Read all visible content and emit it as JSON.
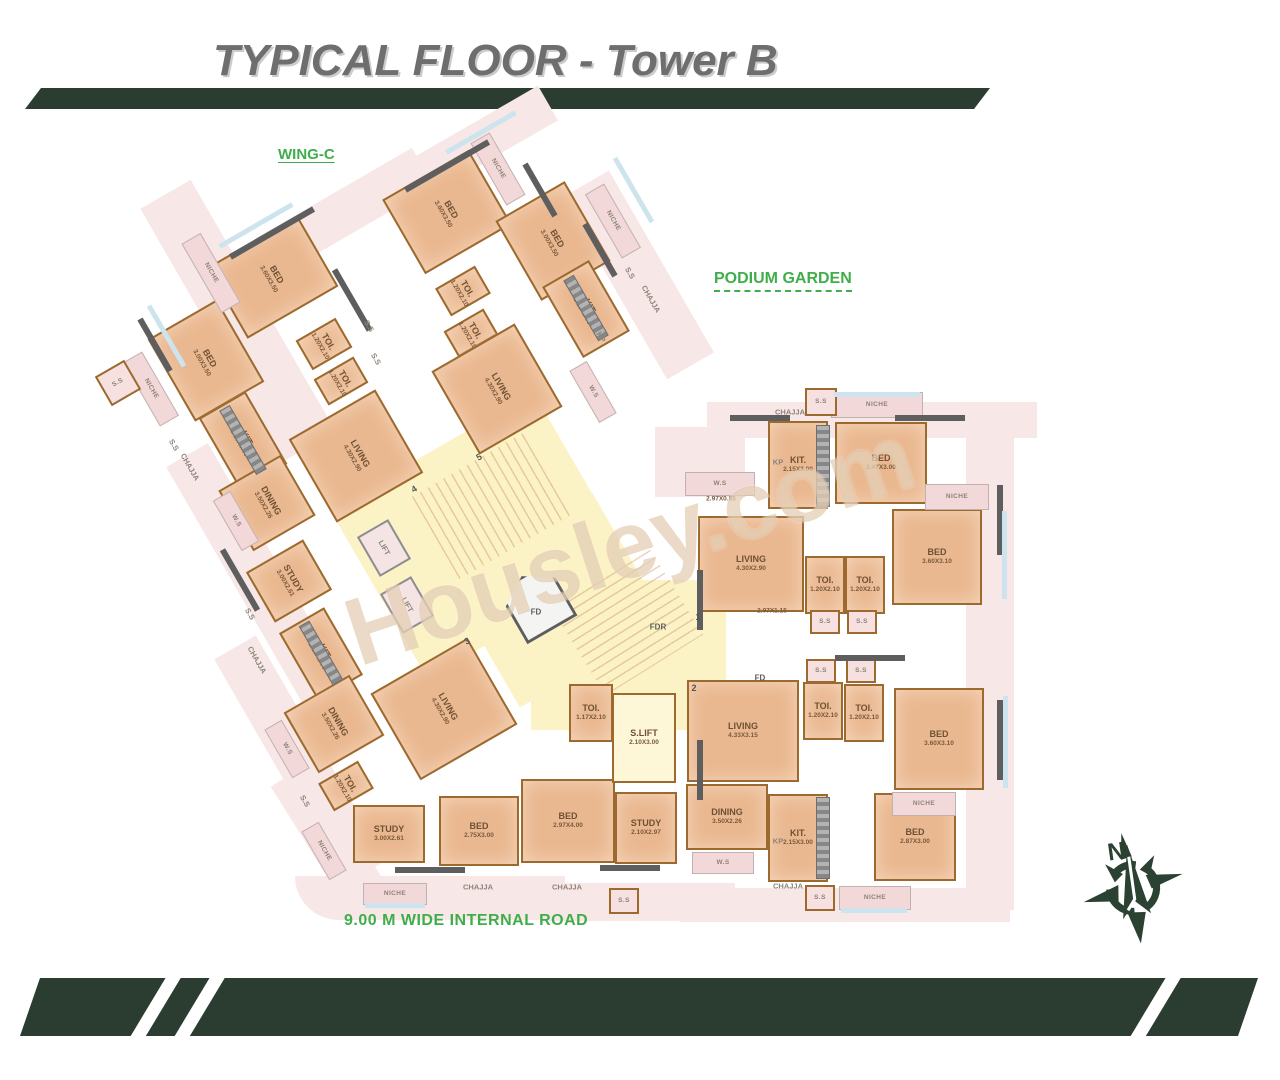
{
  "header": {
    "title": "TYPICAL FLOOR - Tower B"
  },
  "labels": {
    "wing": "WING-C",
    "garden": "PODIUM GARDEN",
    "road": "9.00 M WIDE INTERNAL ROAD",
    "watermark": "Housley.com",
    "compass_north": "N"
  },
  "colors": {
    "banner_green": "#2b3c30",
    "annotation_green": "#3fae4a",
    "room_fill": "#eab890",
    "niche_fill": "#f3d8d9",
    "core_fill": "#fbf2c5",
    "wall_brown": "#9c6a2f",
    "wall_gray": "#5e5e5e",
    "sill_blue": "#cde4ee",
    "title_gray": "#6e6e6e"
  },
  "plan": {
    "items": [
      {
        "k": "outer",
        "x": 238,
        "y": 320,
        "w": 58,
        "h": 290,
        "r": -30
      },
      {
        "k": "outer",
        "x": 345,
        "y": 212,
        "w": 180,
        "h": 44,
        "r": -30
      },
      {
        "k": "outer",
        "x": 262,
        "y": 585,
        "w": 48,
        "h": 300,
        "r": -30
      },
      {
        "k": "outer",
        "x": 300,
        "y": 760,
        "w": 48,
        "h": 260,
        "r": -30
      },
      {
        "k": "outer",
        "x": 330,
        "y": 838,
        "w": 46,
        "h": 150,
        "r": -32
      },
      {
        "k": "outer",
        "x": 470,
        "y": 148,
        "w": 180,
        "h": 40,
        "r": -30
      },
      {
        "k": "outer",
        "x": 638,
        "y": 275,
        "w": 54,
        "h": 210,
        "r": -30
      },
      {
        "k": "outer",
        "x": 430,
        "y": 898,
        "w": 270,
        "h": 44,
        "r": 0,
        "br": 60
      },
      {
        "k": "outer",
        "x": 640,
        "y": 902,
        "w": 190,
        "h": 38,
        "r": 0
      },
      {
        "k": "outer",
        "x": 872,
        "y": 420,
        "w": 330,
        "h": 36,
        "r": 0
      },
      {
        "k": "outer",
        "x": 990,
        "y": 660,
        "w": 48,
        "h": 500,
        "r": 0
      },
      {
        "k": "outer",
        "x": 845,
        "y": 905,
        "w": 330,
        "h": 34,
        "r": 0
      },
      {
        "k": "outer",
        "x": 700,
        "y": 462,
        "w": 90,
        "h": 70,
        "r": 0
      },
      {
        "k": "core",
        "x": 480,
        "y": 535,
        "w": 235,
        "h": 195,
        "r": -30
      },
      {
        "k": "core",
        "x": 628,
        "y": 655,
        "w": 195,
        "h": 150,
        "r": 0
      },
      {
        "k": "core",
        "x": 556,
        "y": 600,
        "w": 170,
        "h": 150,
        "r": -30
      },
      {
        "k": "stairs",
        "x": 492,
        "y": 505,
        "w": 130,
        "h": 95,
        "r": -30
      },
      {
        "k": "stairs",
        "x": 628,
        "y": 622,
        "w": 100,
        "h": 115,
        "r": 58
      },
      {
        "k": "fd",
        "x": 537,
        "y": 603,
        "w": 58,
        "h": 62,
        "r": -30
      },
      {
        "k": "lift",
        "l": "LIFT",
        "x": 384,
        "y": 548,
        "w": 36,
        "h": 46,
        "r": -30,
        "lr": 90
      },
      {
        "k": "lift",
        "l": "LIFT",
        "x": 407,
        "y": 605,
        "w": 36,
        "h": 46,
        "r": -30,
        "lr": 90
      },
      {
        "k": "room",
        "l": "BED",
        "d": "3.60X3.50",
        "x": 272,
        "y": 277,
        "w": 105,
        "h": 82,
        "r": -30,
        "lr": 90
      },
      {
        "k": "room",
        "l": "BED",
        "d": "3.00X3.50",
        "x": 206,
        "y": 360,
        "w": 80,
        "h": 95,
        "r": -30,
        "lr": 90
      },
      {
        "k": "room",
        "l": "TOI.",
        "d": "1.20X2.10",
        "x": 324,
        "y": 344,
        "w": 46,
        "h": 34,
        "r": -30,
        "lr": 90
      },
      {
        "k": "room",
        "l": "TOI.",
        "d": "1.20X2.10",
        "x": 341,
        "y": 381,
        "w": 46,
        "h": 30,
        "r": -30,
        "lr": 90
      },
      {
        "k": "room",
        "l": "KIT.",
        "d": "2.15X3.00",
        "x": 243,
        "y": 441,
        "w": 54,
        "h": 84,
        "r": -30,
        "lr": 90
      },
      {
        "k": "room",
        "l": "DINING",
        "d": "3.50X2.26",
        "x": 267,
        "y": 503,
        "w": 72,
        "h": 70,
        "r": -30,
        "lr": 90
      },
      {
        "k": "room",
        "l": "LIVING",
        "d": "4.30X2.90",
        "x": 356,
        "y": 456,
        "w": 100,
        "h": 96,
        "r": -30,
        "lr": 90
      },
      {
        "k": "room",
        "l": "BED",
        "d": "3.60X3.50",
        "x": 447,
        "y": 212,
        "w": 100,
        "h": 86,
        "r": -30,
        "lr": 90
      },
      {
        "k": "room",
        "l": "BED",
        "d": "3.00X3.50",
        "x": 553,
        "y": 241,
        "w": 80,
        "h": 92,
        "r": -30,
        "lr": 90
      },
      {
        "k": "room",
        "l": "TOI.",
        "d": "1.20X2.10",
        "x": 463,
        "y": 291,
        "w": 46,
        "h": 32,
        "r": -30,
        "lr": 90
      },
      {
        "k": "room",
        "l": "TOI.",
        "d": "1.20X2.10",
        "x": 471,
        "y": 333,
        "w": 46,
        "h": 30,
        "r": -30,
        "lr": 90
      },
      {
        "k": "room",
        "l": "KIT.",
        "d": "2.15X3.00",
        "x": 586,
        "y": 309,
        "w": 54,
        "h": 82,
        "r": -30,
        "lr": 90
      },
      {
        "k": "room",
        "l": "LIVING",
        "d": "4.30X2.90",
        "x": 497,
        "y": 389,
        "w": 96,
        "h": 96,
        "r": -30,
        "lr": 90
      },
      {
        "k": "room",
        "l": "STUDY",
        "d": "3.00X2.61",
        "x": 289,
        "y": 581,
        "w": 66,
        "h": 58,
        "r": -30,
        "lr": 90
      },
      {
        "k": "room",
        "l": "KIT.",
        "d": "2.15X3.00",
        "x": 321,
        "y": 654,
        "w": 52,
        "h": 78,
        "r": -30,
        "lr": 90
      },
      {
        "k": "room",
        "l": "DINING",
        "d": "3.50X2.26",
        "x": 334,
        "y": 724,
        "w": 76,
        "h": 70,
        "r": -30,
        "lr": 90
      },
      {
        "k": "room",
        "l": "LIVING",
        "d": "4.30X2.90",
        "x": 444,
        "y": 709,
        "w": 112,
        "h": 100,
        "r": -30,
        "lr": 90
      },
      {
        "k": "room",
        "l": "TOI.",
        "d": "1.20X2.10",
        "x": 346,
        "y": 786,
        "w": 46,
        "h": 32,
        "r": -30,
        "lr": 90
      },
      {
        "k": "room",
        "l": "STUDY",
        "d": "3.00X2.61",
        "x": 389,
        "y": 834,
        "w": 72,
        "h": 58,
        "r": 0
      },
      {
        "k": "room",
        "l": "BED",
        "d": "2.75X3.00",
        "x": 479,
        "y": 831,
        "w": 80,
        "h": 70,
        "r": 0
      },
      {
        "k": "room",
        "l": "BED",
        "d": "2.97X4.00",
        "x": 568,
        "y": 821,
        "w": 94,
        "h": 84,
        "r": 0
      },
      {
        "k": "room",
        "l": "STUDY",
        "d": "2.10X2.97",
        "x": 646,
        "y": 828,
        "w": 62,
        "h": 72,
        "r": 0
      },
      {
        "k": "room",
        "l": "TOI.",
        "d": "1.17X2.10",
        "x": 591,
        "y": 713,
        "w": 44,
        "h": 58,
        "r": 0
      },
      {
        "k": "corerm",
        "l": "S.LIFT",
        "d": "2.10X3.00",
        "x": 644,
        "y": 738,
        "w": 64,
        "h": 90,
        "r": 0
      },
      {
        "k": "room",
        "l": "KIT.",
        "d": "2.15X3.00",
        "x": 798,
        "y": 465,
        "w": 60,
        "h": 88,
        "r": 0
      },
      {
        "k": "room",
        "l": "BED",
        "d": "2.47X3.00",
        "x": 881,
        "y": 463,
        "w": 92,
        "h": 82,
        "r": 0
      },
      {
        "k": "room",
        "l": "LIVING",
        "d": "4.30X2.90",
        "x": 751,
        "y": 564,
        "w": 106,
        "h": 96,
        "r": 0
      },
      {
        "k": "room",
        "l": "TOI.",
        "d": "1.20X2.10",
        "x": 825,
        "y": 585,
        "w": 40,
        "h": 58,
        "r": 0
      },
      {
        "k": "room",
        "l": "TOI.",
        "d": "1.20X2.10",
        "x": 865,
        "y": 585,
        "w": 40,
        "h": 58,
        "r": 0
      },
      {
        "k": "room",
        "l": "BED",
        "d": "3.60X3.10",
        "x": 937,
        "y": 557,
        "w": 90,
        "h": 96,
        "r": 0
      },
      {
        "k": "room",
        "l": "LIVING",
        "d": "4.33X3.15",
        "x": 743,
        "y": 731,
        "w": 112,
        "h": 102,
        "r": 0
      },
      {
        "k": "room",
        "l": "TOI.",
        "d": "1.20X2.10",
        "x": 823,
        "y": 711,
        "w": 40,
        "h": 58,
        "r": 0
      },
      {
        "k": "room",
        "l": "TOI.",
        "d": "1.20X2.10",
        "x": 864,
        "y": 713,
        "w": 40,
        "h": 58,
        "r": 0
      },
      {
        "k": "room",
        "l": "BED",
        "d": "3.60X3.10",
        "x": 939,
        "y": 739,
        "w": 90,
        "h": 102,
        "r": 0
      },
      {
        "k": "room",
        "l": "DINING",
        "d": "3.50X2.26",
        "x": 727,
        "y": 817,
        "w": 82,
        "h": 66,
        "r": 0
      },
      {
        "k": "room",
        "l": "KIT.",
        "d": "2.15X3.00",
        "x": 798,
        "y": 838,
        "w": 60,
        "h": 88,
        "r": 0
      },
      {
        "k": "room",
        "l": "BED",
        "d": "2.87X3.00",
        "x": 915,
        "y": 837,
        "w": 82,
        "h": 88,
        "r": 0
      },
      {
        "k": "niche",
        "l": "NICHE",
        "x": 211,
        "y": 273,
        "w": 22,
        "h": 80,
        "r": -30,
        "lr": 90
      },
      {
        "k": "niche",
        "l": "NICHE",
        "x": 151,
        "y": 389,
        "w": 22,
        "h": 74,
        "r": -30,
        "lr": 90
      },
      {
        "k": "niche",
        "l": "W.S",
        "x": 236,
        "y": 521,
        "w": 20,
        "h": 58,
        "r": -30,
        "lr": 90
      },
      {
        "k": "niche",
        "l": "W.S",
        "x": 287,
        "y": 749,
        "w": 20,
        "h": 56,
        "r": -30,
        "lr": 90
      },
      {
        "k": "niche",
        "l": "NICHE",
        "x": 324,
        "y": 851,
        "w": 20,
        "h": 56,
        "r": -30,
        "lr": 90
      },
      {
        "k": "niche",
        "l": "NICHE",
        "x": 498,
        "y": 169,
        "w": 22,
        "h": 72,
        "r": -30,
        "lr": 90
      },
      {
        "k": "niche",
        "l": "NICHE",
        "x": 613,
        "y": 221,
        "w": 22,
        "h": 74,
        "r": -30,
        "lr": 90
      },
      {
        "k": "niche",
        "l": "W.S",
        "x": 593,
        "y": 392,
        "w": 20,
        "h": 60,
        "r": -30,
        "lr": 90
      },
      {
        "k": "niche",
        "l": "NICHE",
        "x": 877,
        "y": 405,
        "w": 92,
        "h": 26,
        "r": 0
      },
      {
        "k": "niche",
        "l": "NICHE",
        "x": 957,
        "y": 497,
        "w": 64,
        "h": 26,
        "r": 0
      },
      {
        "k": "niche",
        "l": "W.S",
        "x": 720,
        "y": 484,
        "w": 70,
        "h": 24,
        "r": 0
      },
      {
        "k": "niche",
        "l": "NICHE",
        "x": 924,
        "y": 804,
        "w": 64,
        "h": 24,
        "r": 0
      },
      {
        "k": "niche",
        "l": "NICHE",
        "x": 875,
        "y": 898,
        "w": 72,
        "h": 24,
        "r": 0
      },
      {
        "k": "niche",
        "l": "W.S",
        "x": 723,
        "y": 863,
        "w": 62,
        "h": 22,
        "r": 0
      },
      {
        "k": "niche",
        "l": "NICHE",
        "x": 395,
        "y": 894,
        "w": 64,
        "h": 22,
        "r": 0
      },
      {
        "k": "ssbox",
        "l": "S.S",
        "x": 821,
        "y": 402,
        "w": 32,
        "h": 28,
        "r": 0
      },
      {
        "k": "ssbox",
        "l": "S.S",
        "x": 825,
        "y": 622,
        "w": 30,
        "h": 24,
        "r": 0
      },
      {
        "k": "ssbox",
        "l": "S.S",
        "x": 862,
        "y": 622,
        "w": 30,
        "h": 24,
        "r": 0
      },
      {
        "k": "ssbox",
        "l": "S.S",
        "x": 821,
        "y": 671,
        "w": 30,
        "h": 24,
        "r": 0
      },
      {
        "k": "ssbox",
        "l": "S.S",
        "x": 861,
        "y": 671,
        "w": 30,
        "h": 24,
        "r": 0
      },
      {
        "k": "ssbox",
        "l": "S.S",
        "x": 820,
        "y": 898,
        "w": 30,
        "h": 26,
        "r": 0
      },
      {
        "k": "ssbox",
        "l": "S.S",
        "x": 624,
        "y": 901,
        "w": 30,
        "h": 26,
        "r": 0
      },
      {
        "k": "ssbox",
        "l": "S.S",
        "x": 118,
        "y": 383,
        "w": 34,
        "h": 34,
        "r": -30
      },
      {
        "k": "appl",
        "x": 823,
        "y": 466,
        "w": 14,
        "h": 82,
        "r": 0
      },
      {
        "k": "appl",
        "x": 823,
        "y": 838,
        "w": 14,
        "h": 82,
        "r": 0
      },
      {
        "k": "appl",
        "x": 243,
        "y": 440,
        "w": 12,
        "h": 74,
        "r": -30
      },
      {
        "k": "appl",
        "x": 321,
        "y": 653,
        "w": 12,
        "h": 68,
        "r": -30
      },
      {
        "k": "appl",
        "x": 586,
        "y": 308,
        "w": 12,
        "h": 70,
        "r": -30
      },
      {
        "k": "wall",
        "x": 272,
        "y": 233,
        "w": 96,
        "h": 6,
        "r": -30
      },
      {
        "k": "wall",
        "x": 352,
        "y": 300,
        "w": 6,
        "h": 70,
        "r": -30
      },
      {
        "k": "wall",
        "x": 447,
        "y": 166,
        "w": 96,
        "h": 6,
        "r": -30
      },
      {
        "k": "wall",
        "x": 540,
        "y": 190,
        "w": 6,
        "h": 60,
        "r": -30
      },
      {
        "k": "wall",
        "x": 600,
        "y": 250,
        "w": 6,
        "h": 60,
        "r": -30
      },
      {
        "k": "wall",
        "x": 155,
        "y": 345,
        "w": 6,
        "h": 60,
        "r": -30
      },
      {
        "k": "wall",
        "x": 240,
        "y": 580,
        "w": 6,
        "h": 70,
        "r": -30
      },
      {
        "k": "wall",
        "x": 930,
        "y": 418,
        "w": 70,
        "h": 6,
        "r": 0
      },
      {
        "k": "wall",
        "x": 1000,
        "y": 520,
        "w": 6,
        "h": 70,
        "r": 0
      },
      {
        "k": "wall",
        "x": 1000,
        "y": 740,
        "w": 6,
        "h": 80,
        "r": 0
      },
      {
        "k": "wall",
        "x": 700,
        "y": 600,
        "w": 6,
        "h": 60,
        "r": 0
      },
      {
        "k": "wall",
        "x": 700,
        "y": 770,
        "w": 6,
        "h": 60,
        "r": 0
      },
      {
        "k": "wall",
        "x": 760,
        "y": 418,
        "w": 60,
        "h": 6,
        "r": 0
      },
      {
        "k": "wall",
        "x": 870,
        "y": 658,
        "w": 70,
        "h": 6,
        "r": 0
      },
      {
        "k": "wall",
        "x": 430,
        "y": 870,
        "w": 70,
        "h": 6,
        "r": 0
      },
      {
        "k": "wall",
        "x": 630,
        "y": 868,
        "w": 60,
        "h": 6,
        "r": 0
      },
      {
        "k": "sill",
        "x": 256,
        "y": 225,
        "w": 84,
        "h": 5,
        "r": -30
      },
      {
        "k": "sill",
        "x": 166,
        "y": 336,
        "w": 5,
        "h": 70,
        "r": -30
      },
      {
        "k": "sill",
        "x": 481,
        "y": 132,
        "w": 80,
        "h": 5,
        "r": -30
      },
      {
        "k": "sill",
        "x": 633,
        "y": 190,
        "w": 5,
        "h": 74,
        "r": -30
      },
      {
        "k": "sill",
        "x": 877,
        "y": 394,
        "w": 86,
        "h": 5,
        "r": 0
      },
      {
        "k": "sill",
        "x": 1004,
        "y": 555,
        "w": 5,
        "h": 88,
        "r": 0
      },
      {
        "k": "sill",
        "x": 1005,
        "y": 742,
        "w": 5,
        "h": 92,
        "r": 0
      },
      {
        "k": "sill",
        "x": 874,
        "y": 910,
        "w": 66,
        "h": 5,
        "r": 0
      },
      {
        "k": "sill",
        "x": 395,
        "y": 905,
        "w": 60,
        "h": 5,
        "r": 0
      }
    ],
    "marks": [
      {
        "t": "CHAJJA",
        "x": 190,
        "y": 467,
        "r": 60
      },
      {
        "t": "CHAJJA",
        "x": 651,
        "y": 299,
        "r": 60
      },
      {
        "t": "CHAJJA",
        "x": 257,
        "y": 660,
        "r": 60
      },
      {
        "t": "CHAJJA",
        "x": 790,
        "y": 412,
        "r": 0
      },
      {
        "t": "CHAJJA",
        "x": 478,
        "y": 887,
        "r": 0
      },
      {
        "t": "CHAJJA",
        "x": 567,
        "y": 887,
        "r": 0
      },
      {
        "t": "CHAJJA",
        "x": 788,
        "y": 886,
        "r": 0
      },
      {
        "t": "S.S",
        "x": 369,
        "y": 326,
        "r": 60
      },
      {
        "t": "S.S",
        "x": 376,
        "y": 359,
        "r": 60
      },
      {
        "t": "S.S",
        "x": 174,
        "y": 445,
        "r": 60
      },
      {
        "t": "S.S",
        "x": 250,
        "y": 614,
        "r": 60
      },
      {
        "t": "S.S",
        "x": 305,
        "y": 801,
        "r": 60
      },
      {
        "t": "S.S",
        "x": 630,
        "y": 273,
        "r": 60
      },
      {
        "t": "KP",
        "x": 778,
        "y": 462,
        "r": 0
      },
      {
        "t": "KP",
        "x": 778,
        "y": 841,
        "r": 0
      },
      {
        "t": "KP",
        "x": 601,
        "y": 337,
        "r": 60
      },
      {
        "t": "FD",
        "x": 536,
        "y": 612,
        "r": 0,
        "c": "fd"
      },
      {
        "t": "FD",
        "x": 760,
        "y": 678,
        "r": 0,
        "c": "fd"
      },
      {
        "t": "FDR",
        "x": 658,
        "y": 627,
        "r": 0,
        "c": "fd"
      },
      {
        "t": "2.97X0.85",
        "x": 721,
        "y": 499,
        "r": 0,
        "c": "dim"
      },
      {
        "t": "2.97X1.15",
        "x": 772,
        "y": 611,
        "r": 0,
        "c": "dim"
      },
      {
        "t": "1",
        "x": 698,
        "y": 617,
        "r": 0,
        "c": "num"
      },
      {
        "t": "2",
        "x": 694,
        "y": 688,
        "r": 0,
        "c": "num"
      },
      {
        "t": "3",
        "x": 467,
        "y": 641,
        "r": -30,
        "c": "num"
      },
      {
        "t": "4",
        "x": 414,
        "y": 489,
        "r": -30,
        "c": "num"
      },
      {
        "t": "5",
        "x": 479,
        "y": 457,
        "r": -30,
        "c": "num"
      }
    ]
  }
}
